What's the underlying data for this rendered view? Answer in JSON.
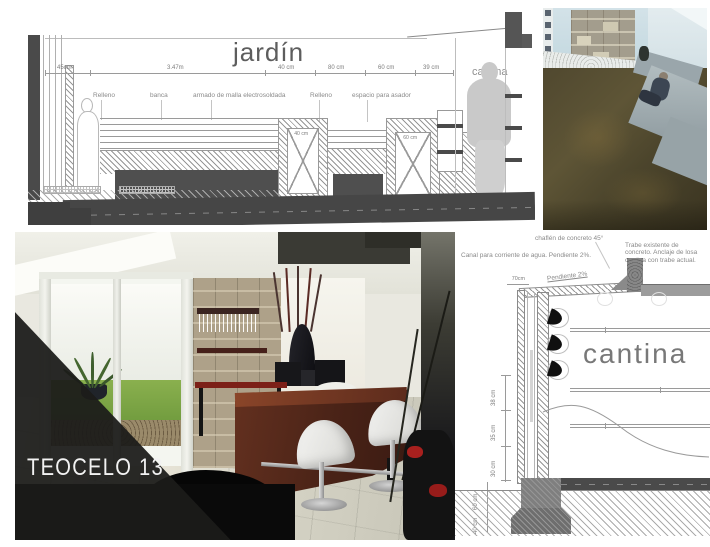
{
  "jardin": {
    "title": "jardín",
    "room_label": "cantina",
    "dims_top": [
      "45cm",
      "3.47m",
      "40 cm",
      "80 cm",
      "60 cm",
      "39 cm"
    ],
    "labels": [
      "Relleno",
      "banca",
      "armado de malla electrosoldada",
      "Relleno",
      "espacio para asador"
    ],
    "niche_dims": [
      "40 cm",
      "60 cm"
    ]
  },
  "interior_photo": {
    "project_label": "TEOCELO 13"
  },
  "cantina_detail": {
    "title": "cantina",
    "annotations": {
      "canal": "Canal para corriente de agua. Pendiente 2%.",
      "chaflan": "chaflén de concreto 45°",
      "trabe": "Trabe existente de concreto. Anclaje de losa cantina con trabe actual.",
      "pendiente": "Pendiente 2%"
    },
    "dim_top": "70cm",
    "dims_left": [
      "38 cm",
      "35 cm",
      "30 cm",
      "60 cm",
      "40 cm"
    ]
  },
  "colors": {
    "wood_bar": "#5c2b1c",
    "overlay_triangle": "#1c1c1a",
    "concrete_bench": "#9aa4a8",
    "grass_bright": "#7aa743",
    "grass_patio_dark": "#4a432c",
    "drawing_dark": "#4a4a4a"
  }
}
